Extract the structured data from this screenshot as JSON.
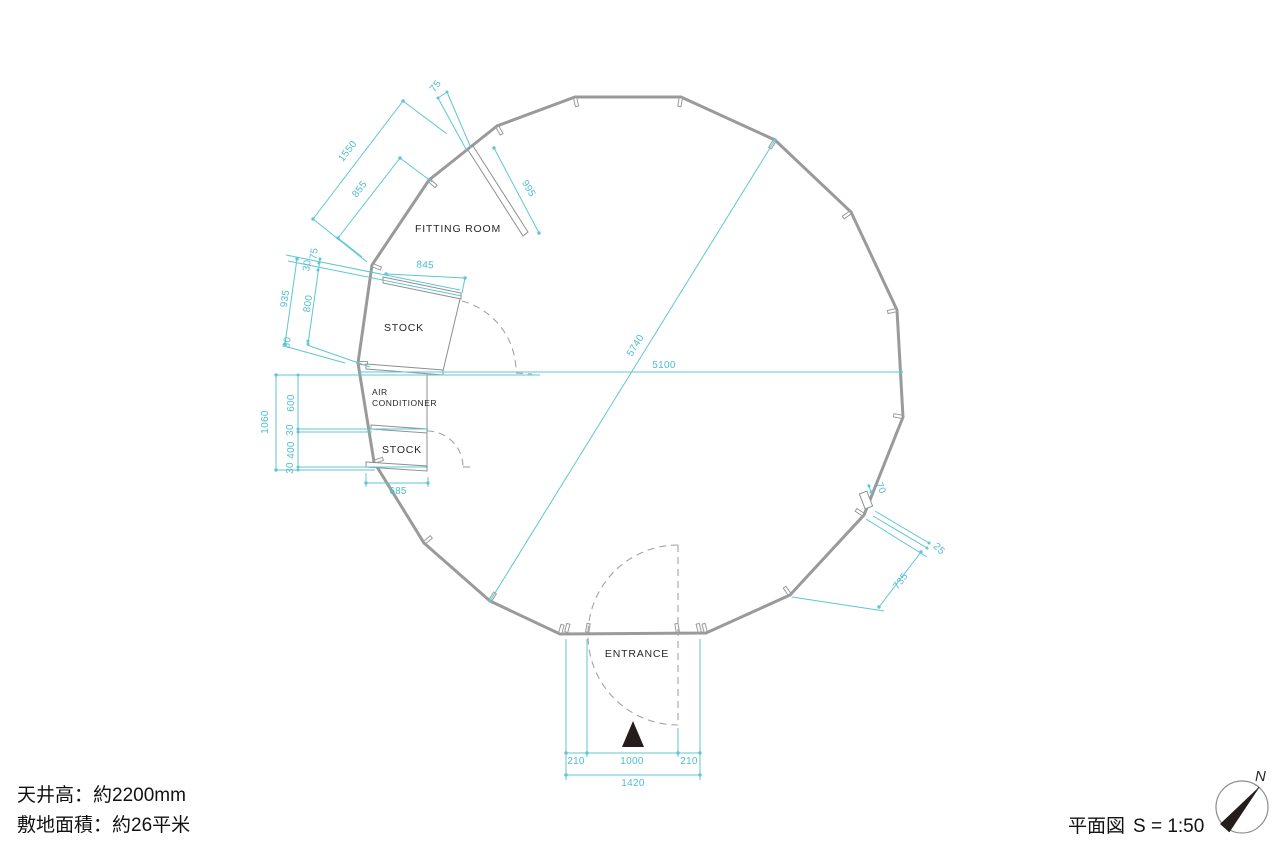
{
  "plan": {
    "labels": {
      "fitting_room": "FITTING ROOM",
      "stock_upper": "STOCK",
      "ac_line1": "AIR",
      "ac_line2": "CONDITIONER",
      "stock_lower": "STOCK",
      "entrance": "ENTRANCE"
    },
    "dims": {
      "d1550": "1550",
      "d855": "855",
      "d75_top": "75",
      "d995": "995",
      "d845": "845",
      "d30_a": "30",
      "d75_b": "75",
      "d935": "935",
      "d800": "800",
      "d30_b": "30",
      "d1060": "1060",
      "d600": "600",
      "d30_c": "30",
      "d400": "400",
      "d30_d": "30",
      "d685": "685",
      "d5740": "5740",
      "d5100": "5100",
      "d70": "70",
      "d25": "25",
      "d735": "735",
      "d210_left": "210",
      "d1000": "1000",
      "d210_right": "210",
      "d1420": "1420"
    }
  },
  "footer": {
    "ceiling_note": "天井高：約2200mm",
    "area_note": "敷地面積：約26平米",
    "drawing_title": "平面図",
    "scale": "S = 1:50",
    "north": "N"
  },
  "colors": {
    "dimension": "#5fc6d4",
    "wall": "#9a9a9a",
    "text": "#2b2626"
  }
}
